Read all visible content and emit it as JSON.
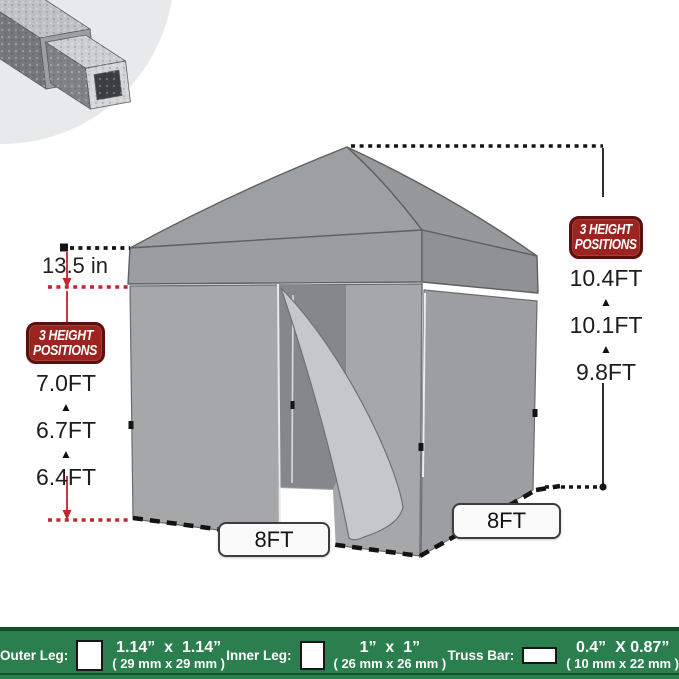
{
  "left_dim": {
    "top_value": "13.5 in",
    "badge": {
      "line1": "3 HEIGHT",
      "line2": "POSITIONS"
    },
    "heights": [
      "7.0FT",
      "6.7FT",
      "6.4FT"
    ]
  },
  "right_dim": {
    "badge": {
      "line1": "3 HEIGHT",
      "line2": "POSITIONS"
    },
    "heights": [
      "10.4FT",
      "10.1FT",
      "9.8FT"
    ]
  },
  "glyphs": {
    "up_arrow": "▲"
  },
  "base_labels": {
    "front": "8FT",
    "side": "8FT"
  },
  "spec_bar": {
    "items": [
      {
        "label": "Outer Leg:",
        "icon": "square-tube-cross-section-icon",
        "size_in": "1.14”  x  1.14”",
        "size_mm": "( 29 mm x 29 mm )"
      },
      {
        "label": "Inner Leg:",
        "icon": "square-tube-cross-section-icon",
        "size_in": "1”  x  1”",
        "size_mm": "( 26 mm x 26 mm )"
      },
      {
        "label": "Truss Bar:",
        "icon": "rectangular-tube-cross-section-icon",
        "size_in": "0.4”  X 0.87”",
        "size_mm": "( 10 mm x 22 mm )"
      }
    ]
  },
  "colors": {
    "accent_red": "#c1272d",
    "badge_red": "#9c2420",
    "bar_green": "#2b7f4e",
    "tent_gray": "#a5a7a9"
  }
}
